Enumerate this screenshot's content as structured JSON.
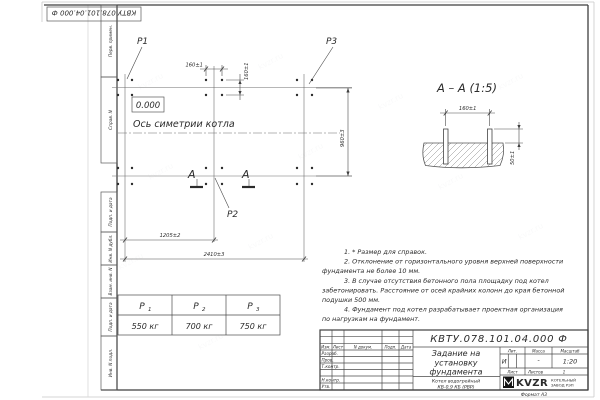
{
  "watermark": {
    "text": "kvzr.ru"
  },
  "top_stamp": {
    "designation": "КВТУ.078.101.04.000  Ф"
  },
  "margin_strip": {
    "labels": [
      "Перв. примен.",
      "Справ. N",
      "Подп. и дата",
      "Инв. N дубл.",
      "Взам. инв. N",
      "Подп. и дата",
      "Инв. N подл."
    ]
  },
  "plan": {
    "point_labels": {
      "p1": "P1",
      "p2": "P2",
      "p3": "P3"
    },
    "elevation": "0.000",
    "axis_label": "Ось симетрии котла",
    "section_letter": "А",
    "dims": {
      "top_horizontal": "160±1",
      "top_vertical": "160±1",
      "right_vertical": "960±3",
      "bottom_inner": "1205±2",
      "bottom_outer": "2410±3"
    }
  },
  "section_view": {
    "title": "А – А (1:5)",
    "dims": {
      "bolt_spacing": "160±1",
      "bolt_height": "50±1"
    }
  },
  "notes": {
    "lines": [
      "1. * Размер для справок.",
      "2. Отклонение от горизонтального уровня верхней поверхности",
      "фундамента не более 10 мм.",
      "3. В случае отсутствия бетонного пола площадку под котел",
      "забетонировать. Расстояние от осей крайних колонн до края бетонной",
      "подушки 500 мм.",
      "4. Фундамент под котел разрабатывает проектная организация",
      "по нагрузкам на фундамент."
    ]
  },
  "loads_table": {
    "columns": [
      {
        "name": "Р",
        "sub": "1",
        "value": "550 кг"
      },
      {
        "name": "Р",
        "sub": "2",
        "value": "700 кг"
      },
      {
        "name": "Р",
        "sub": "3",
        "value": "750 кг"
      }
    ]
  },
  "title_block": {
    "designation": "КВТУ.078.101.04.000  Ф",
    "title_lines": [
      "Задание на",
      "установку",
      "фундамента"
    ],
    "product_lines": [
      "Котел водогрейный",
      "КВ-0,9 КБ (РВР)"
    ],
    "columns": {
      "izm": "Изм.",
      "list": "Лист",
      "doc": "N докум.",
      "sign": "Подп.",
      "date": "Дата"
    },
    "rows": {
      "developed": "Разраб.",
      "checked": "Пров.",
      "tcontrol": "Т.контр.",
      "ncontrol": "Н.контр.",
      "approved": "Утв."
    },
    "lit": {
      "header": "Лит.",
      "value": "И"
    },
    "mass": {
      "header": "Масса",
      "value": "-"
    },
    "scale": {
      "header": "Масштаб",
      "value": "1:20"
    },
    "sheet": {
      "header": "Лист",
      "sheets_header": "Листов",
      "sheets_value": "1"
    },
    "company": {
      "logo": "KVZR",
      "name_line1": "КОТЕЛЬНЫЙ",
      "name_line2": "ЗАВОД РЭП"
    },
    "format": "Формат А3"
  }
}
